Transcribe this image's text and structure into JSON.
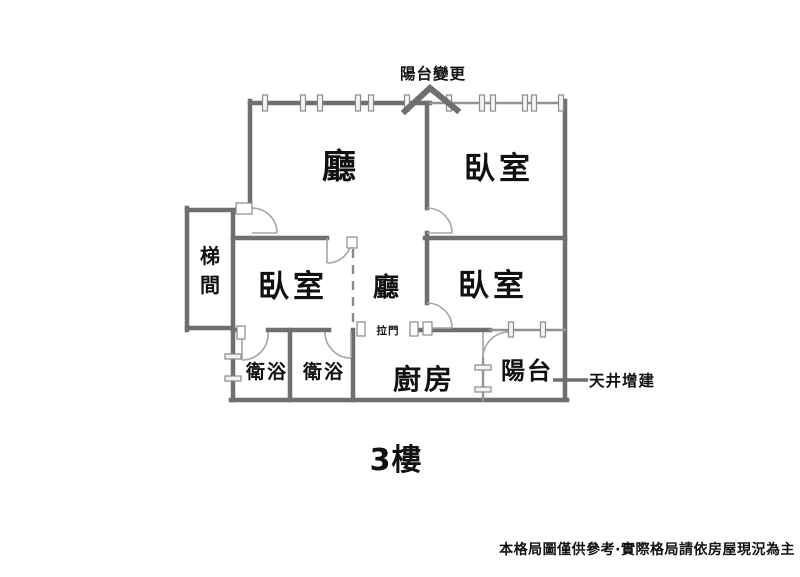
{
  "floor_label": "3樓",
  "disclaimer": "本格局圖僅供參考·實際格局請依房屋現況為主",
  "annotations": {
    "balcony_change": "陽台變更",
    "sliding_door": "拉門",
    "lightwell_addition": "天井增建"
  },
  "rooms": {
    "living_room": "廳",
    "hall": "廳",
    "bedroom_top_right": "臥室",
    "bedroom_mid_left": "臥室",
    "bedroom_mid_right": "臥室",
    "stairwell_chars": [
      "梯",
      "間"
    ],
    "bathroom_left": "衛浴",
    "bathroom_right": "衛浴",
    "kitchen": "廚房",
    "balcony": "陽台"
  },
  "colors": {
    "wall": "#6f6f6f",
    "wall_light": "#949494",
    "door": "#a5a5a5",
    "text": "#111111",
    "background": "#ffffff"
  }
}
